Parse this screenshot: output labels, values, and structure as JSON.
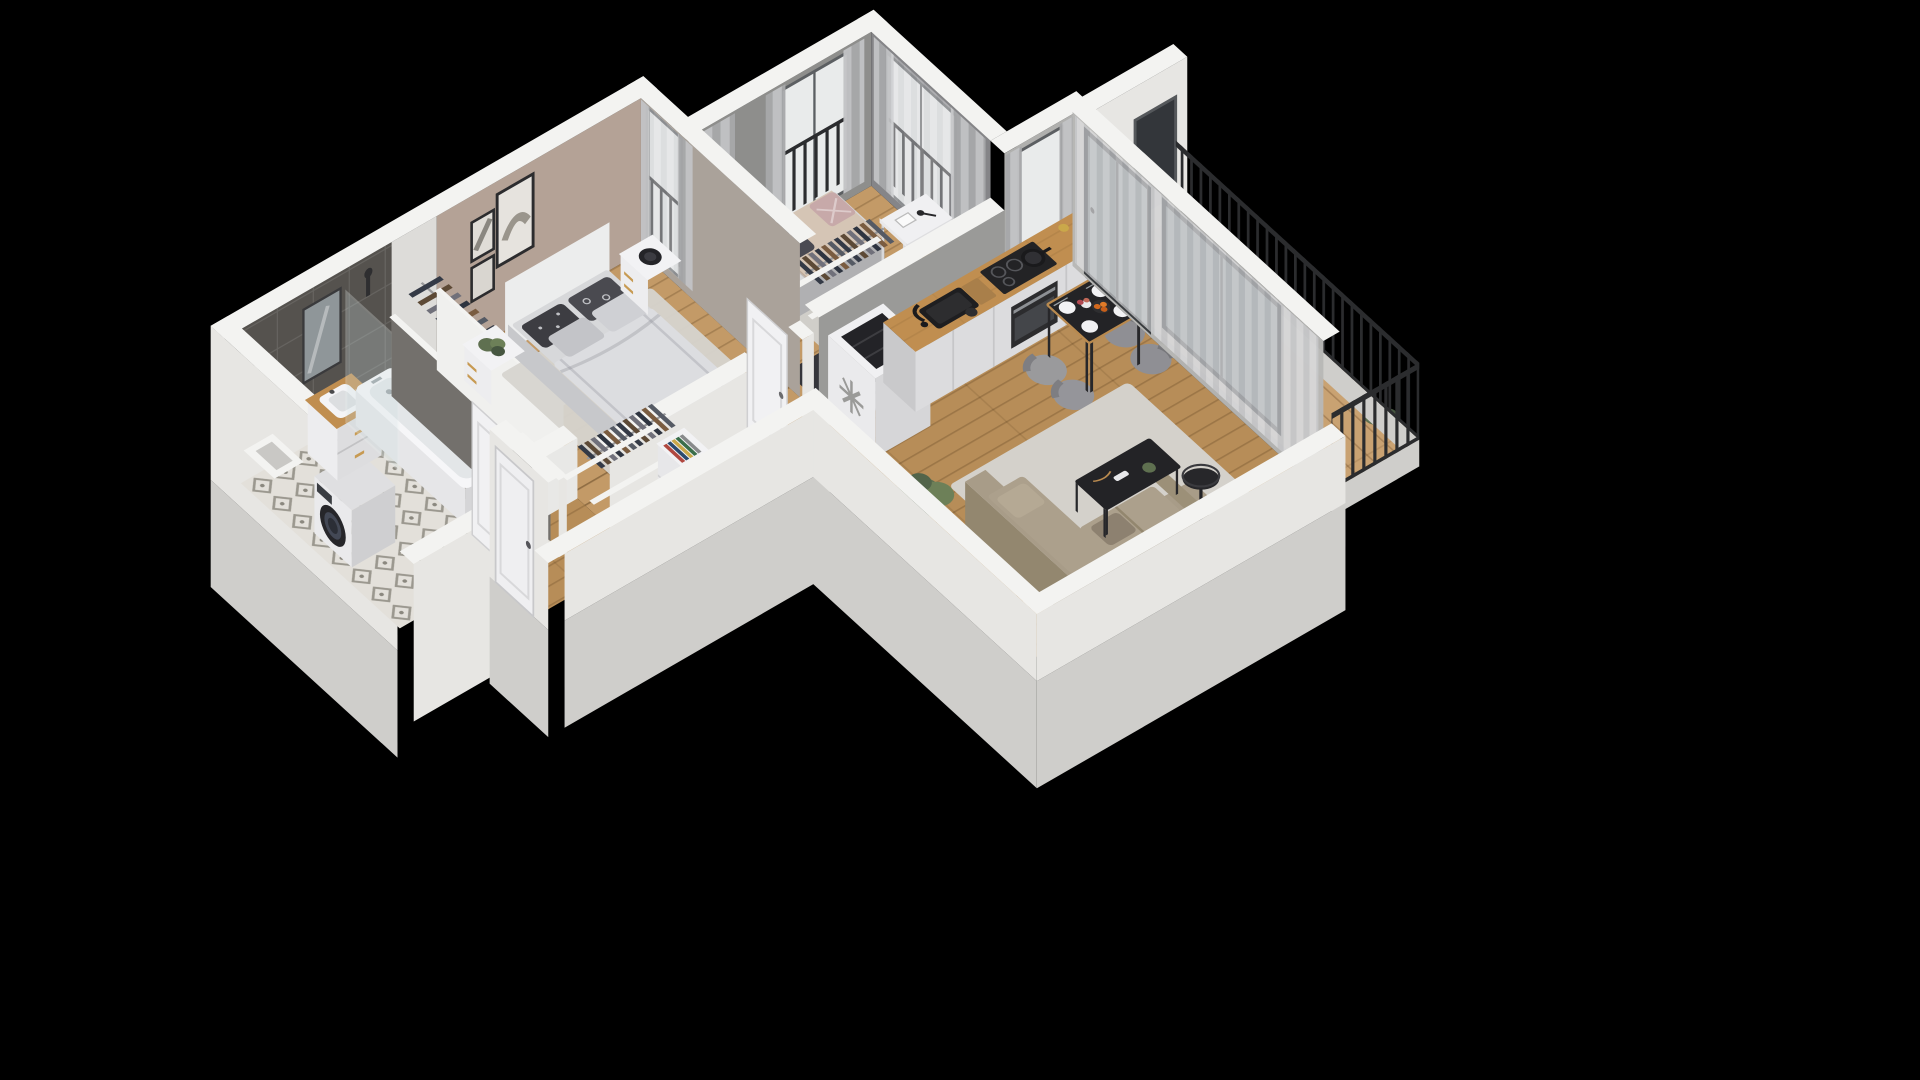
{
  "scene": {
    "type": "isometric-3d-floor-plan",
    "view": "cutaway-axonometric-render",
    "background": "#000000"
  },
  "colors": {
    "bg": "#000000",
    "wall_top": "#f3f3f1",
    "wall_ext": "#e7e6e3",
    "wall_ext_shade": "#cfcecb",
    "taupe": "#b4a296",
    "dark_tile": "#55524e",
    "gray_wall": "#8e8e8c",
    "wood": "#c39a67",
    "wood_hall": "#b78d58",
    "tile_floor": "#e3e0da",
    "rug": "#d4d1cb",
    "sofa": "#a89c88",
    "linen": "#d7d8da",
    "curtain": "#b4b5b7",
    "sheer": "#dddddf",
    "counter_wood": "#c08e50",
    "black_furn": "#27272a",
    "railing": "#2b2c2e",
    "plant": "#5f7050",
    "white_furn": "#ececee",
    "glass": "#b7c3c5",
    "olive": "#8f8a5c",
    "pink": "#c7a9a9",
    "blanket": "#d5c5b5",
    "balcony_wood": "#c9a272"
  },
  "rooms": [
    {
      "id": "bathroom",
      "items": [
        "washing-machine",
        "vanity-with-sink",
        "mirror",
        "shower-glass",
        "bathtub",
        "dark-tiled-wall",
        "patterned-tile-floor",
        "wall-shaft"
      ]
    },
    {
      "id": "closet",
      "items": [
        "clothes-rail",
        "hanging-clothes"
      ]
    },
    {
      "id": "bedroom",
      "items": [
        "double-bed",
        "headboard",
        "patterned-pillows",
        "duvet",
        "nightstand-left",
        "potted-plant",
        "nightstand-right",
        "table-lamp",
        "wall-art-frames",
        "window-with-curtains",
        "area-rug"
      ]
    },
    {
      "id": "kids-room",
      "items": [
        "daybed",
        "olive-cushion",
        "dotted-cushion",
        "pink-cushion",
        "desk",
        "desk-chair",
        "open-wardrobe",
        "area-rug",
        "french-windows-with-railing",
        "curtains"
      ]
    },
    {
      "id": "hallway",
      "items": [
        "entry-door",
        "bathroom-door",
        "bedroom-door",
        "kids-room-door",
        "open-wardrobe",
        "shelf-with-books",
        "wood-floor"
      ]
    },
    {
      "id": "kitchen",
      "items": [
        "integrated-fridge",
        "snowflake-badge",
        "wooden-countertop",
        "black-sink",
        "black-faucet",
        "induction-hob",
        "pot",
        "oven",
        "cabinet-fronts",
        "window-with-curtains"
      ]
    },
    {
      "id": "dining",
      "items": [
        "black-dining-table",
        "upholstered-chairs",
        "plates",
        "cutlery",
        "flower-vase",
        "fruit-bowl"
      ]
    },
    {
      "id": "living-room",
      "items": [
        "corner-sofa",
        "seat-cushions",
        "coffee-table",
        "floor-lamp",
        "area-rug",
        "tall-plant",
        "glass-balcony-door",
        "sheer-curtains"
      ]
    },
    {
      "id": "balcony",
      "items": [
        "wood-decking",
        "white-parapet",
        "metal-railing",
        "neighbour-window",
        "potted-plant"
      ]
    }
  ],
  "icons": {
    "fridge_badge": "snowflake-icon"
  }
}
